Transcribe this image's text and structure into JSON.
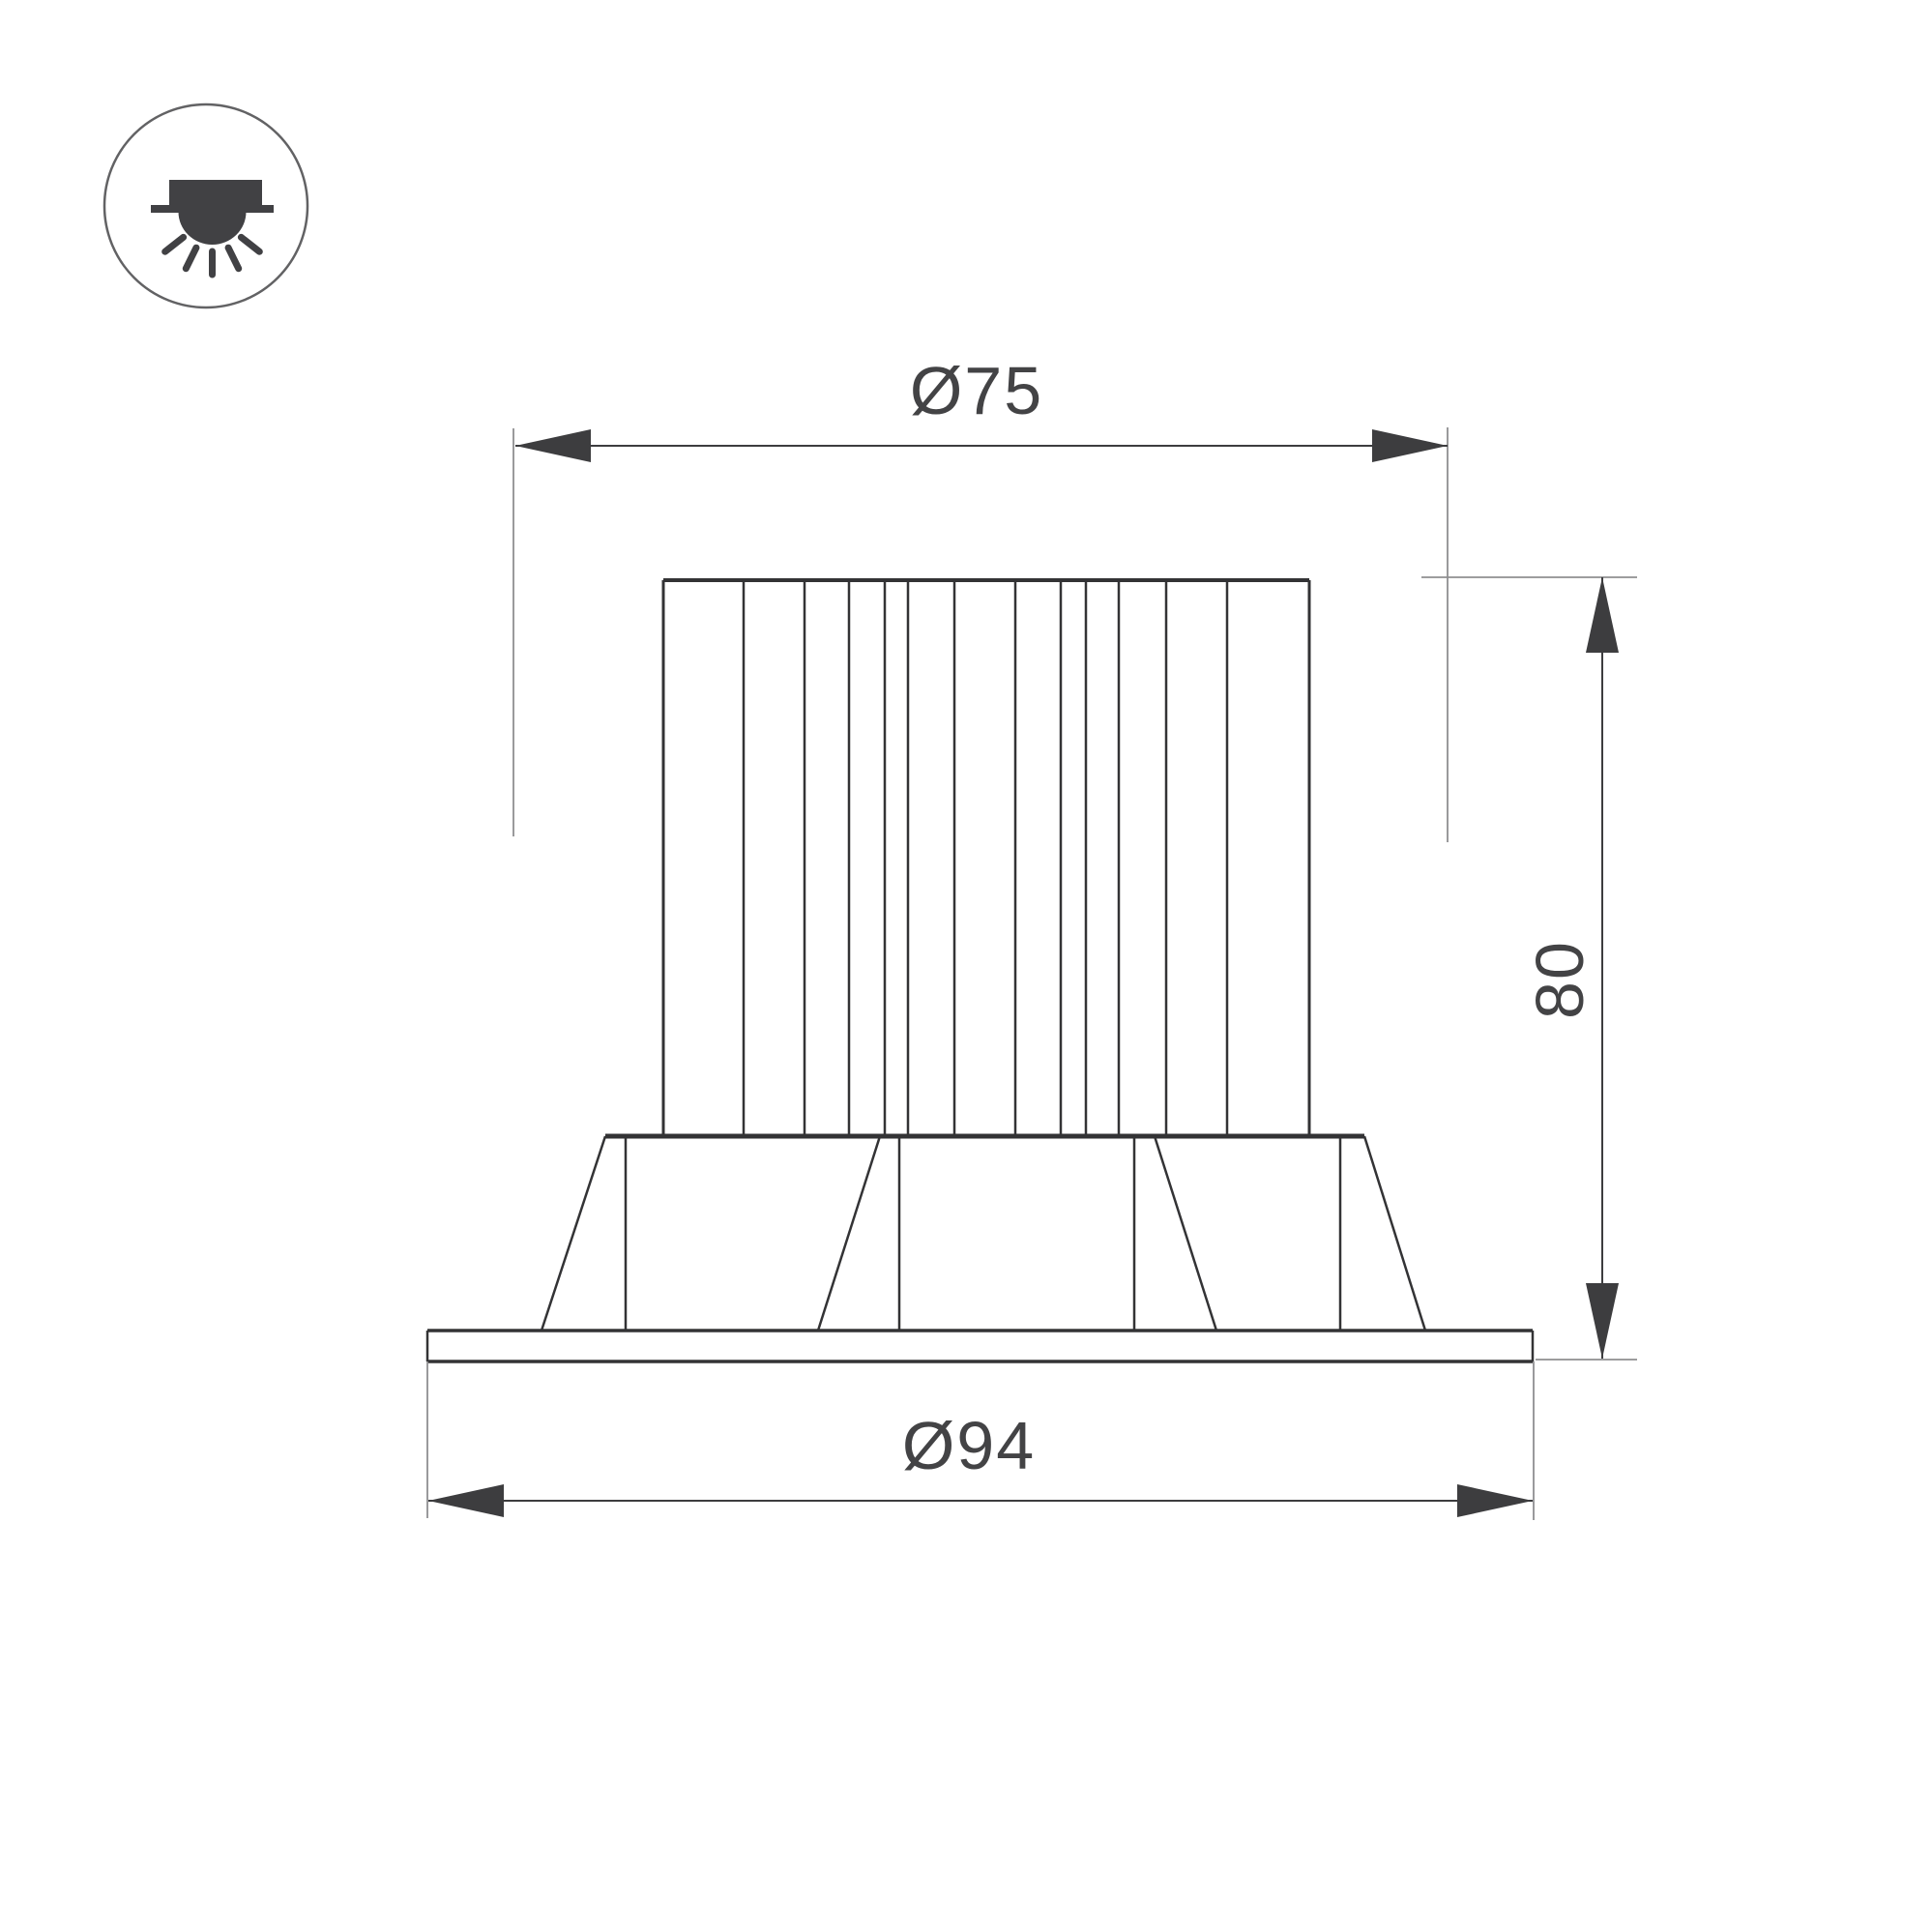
{
  "drawing": {
    "type": "technical-dimension-drawing",
    "subject": "recessed-downlight-front-view",
    "dimensions": {
      "top_diameter_label": "Ø75",
      "bottom_diameter_label": "Ø94",
      "height_label": "80"
    },
    "icon": {
      "name": "recessed-downlight-icon"
    },
    "colors": {
      "background": "#ffffff",
      "object_line": "#333335",
      "dimension_line": "#3d3d3f",
      "extension_line": "#8f8f91",
      "label_text": "#434345",
      "icon_fill": "#414144",
      "icon_circle_stroke": "#626264"
    }
  }
}
